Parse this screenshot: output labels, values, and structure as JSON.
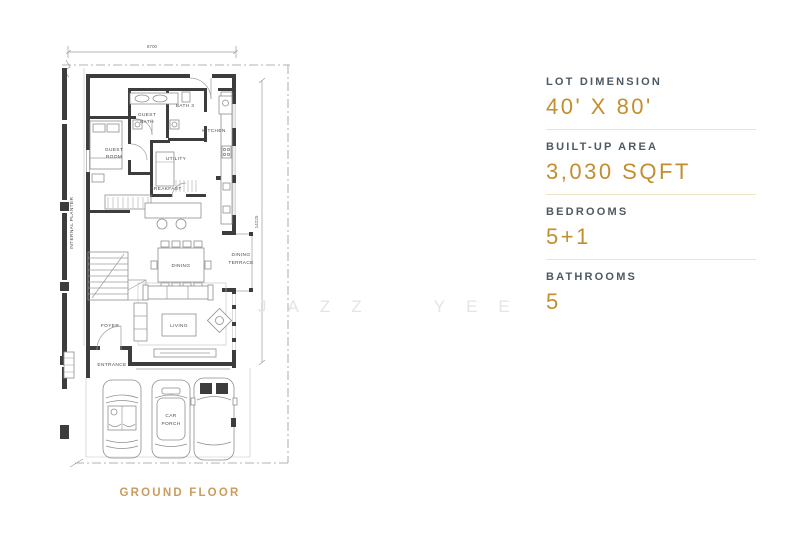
{
  "plan": {
    "title": "GROUND FLOOR",
    "width_dim": "8700",
    "depth_dim": "14225",
    "labels": {
      "guest_room": [
        "GUEST",
        "ROOM"
      ],
      "guest_bath": [
        "GUEST",
        "BATH"
      ],
      "bath3": [
        "BATH 3"
      ],
      "kitchen": [
        "KITCHEN"
      ],
      "utility": [
        "UTILITY"
      ],
      "breakfast_area": [
        "BREAKFAST",
        "AREA"
      ],
      "dining": [
        "DINING"
      ],
      "dining_terrace": [
        "DINING",
        "TERRACE"
      ],
      "internal_planter": [
        "INTERNAL PLANTER"
      ],
      "foyer": [
        "FOYER"
      ],
      "living": [
        "LIVING"
      ],
      "entrance": [
        "ENTRANCE"
      ],
      "car_porch": [
        "CAR",
        "PORCH"
      ]
    }
  },
  "watermark": {
    "text": "JAZZ  YEE"
  },
  "specs": {
    "accent_color": "#c28e2e",
    "label_color": "#4d5963",
    "divider_color": "#f2e3c7",
    "title_color": "#c99c60",
    "items": [
      {
        "label": "LOT DIMENSION",
        "value": "40' X 80'"
      },
      {
        "label": "BUILT-UP AREA",
        "value": "3,030 SQFT"
      },
      {
        "label": "BEDROOMS",
        "value": "5+1"
      },
      {
        "label": "BATHROOMS",
        "value": "5"
      }
    ]
  }
}
